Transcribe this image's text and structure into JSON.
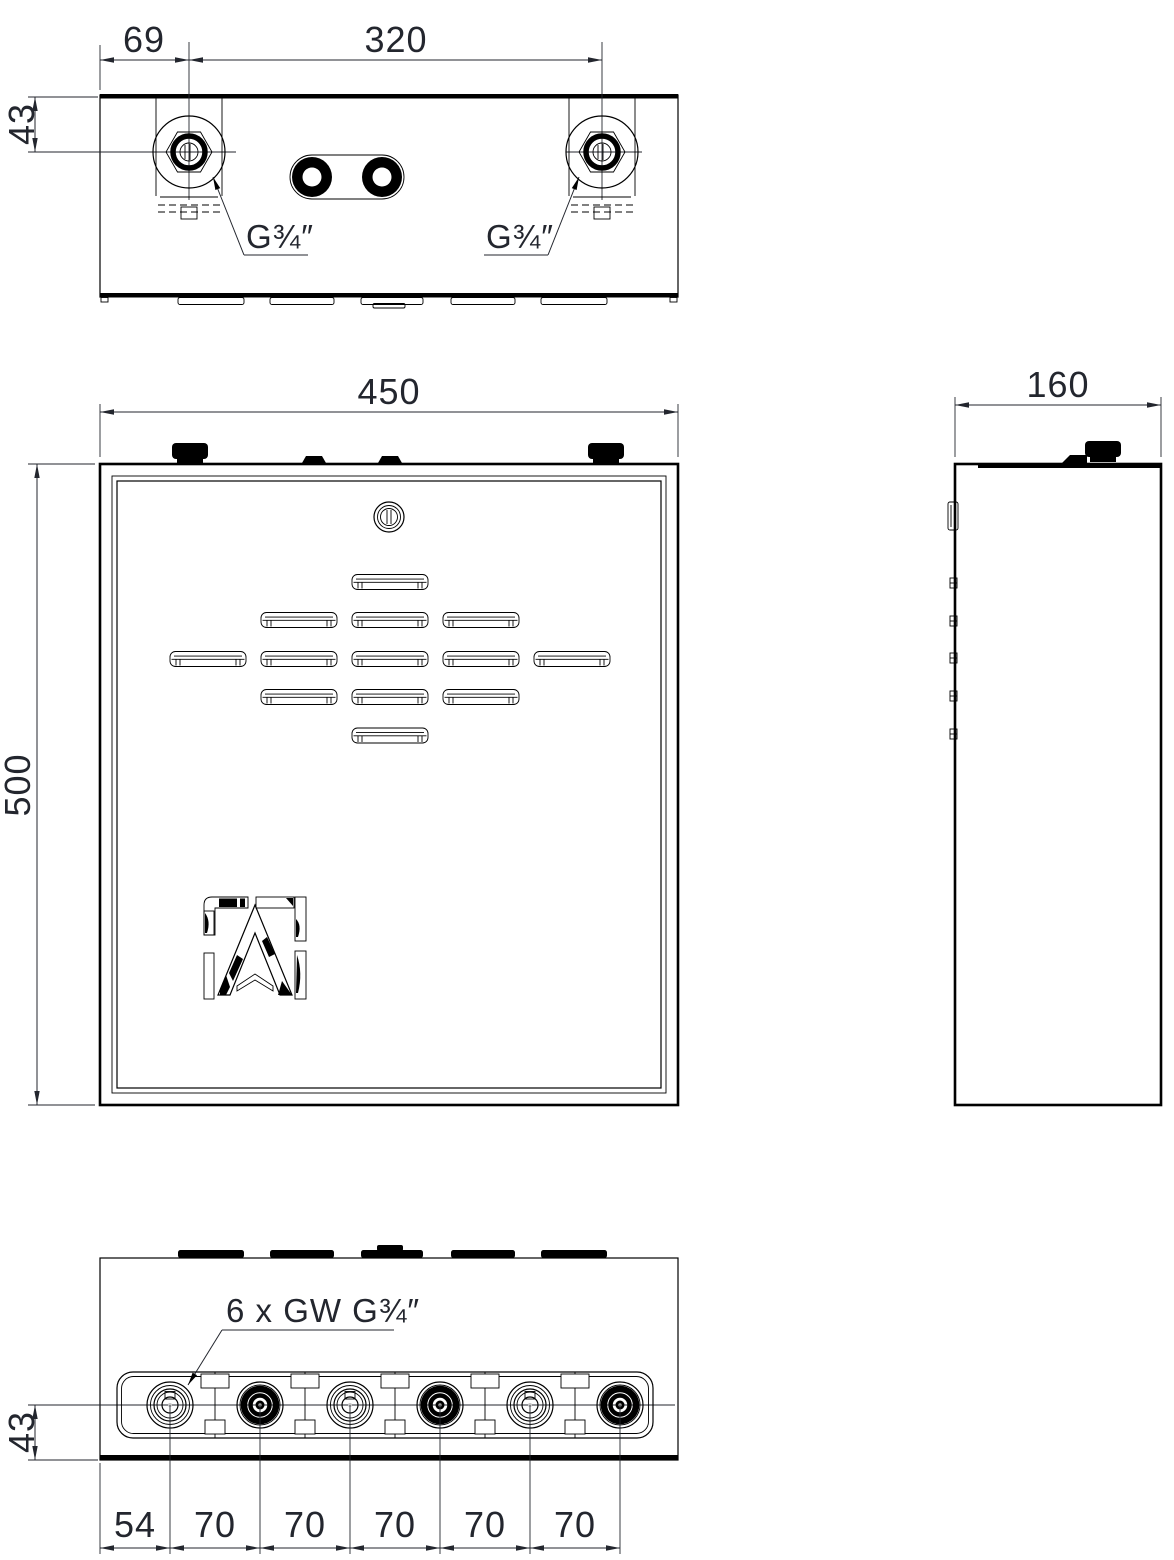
{
  "drawing": {
    "type": "technical-drawing",
    "subject": "wall distribution cabinet with manifold, three orthographic views",
    "colors": {
      "background": "#ffffff",
      "line": "#000000",
      "text": "#23262e"
    },
    "views": {
      "top": {
        "dims": {
          "port_offset_left": "69",
          "port_spacing": "320",
          "port_depth": "43"
        },
        "port_label_left": "G¾″",
        "port_label_right": "G¾″"
      },
      "front": {
        "dims": {
          "width": "450",
          "height": "500"
        }
      },
      "side": {
        "dims": {
          "depth": "160"
        }
      },
      "bottom": {
        "connections_label": "6 x GW G¾″",
        "dims": {
          "valve_depth": "43",
          "segments": [
            "54",
            "70",
            "70",
            "70",
            "70",
            "70"
          ]
        }
      }
    }
  }
}
